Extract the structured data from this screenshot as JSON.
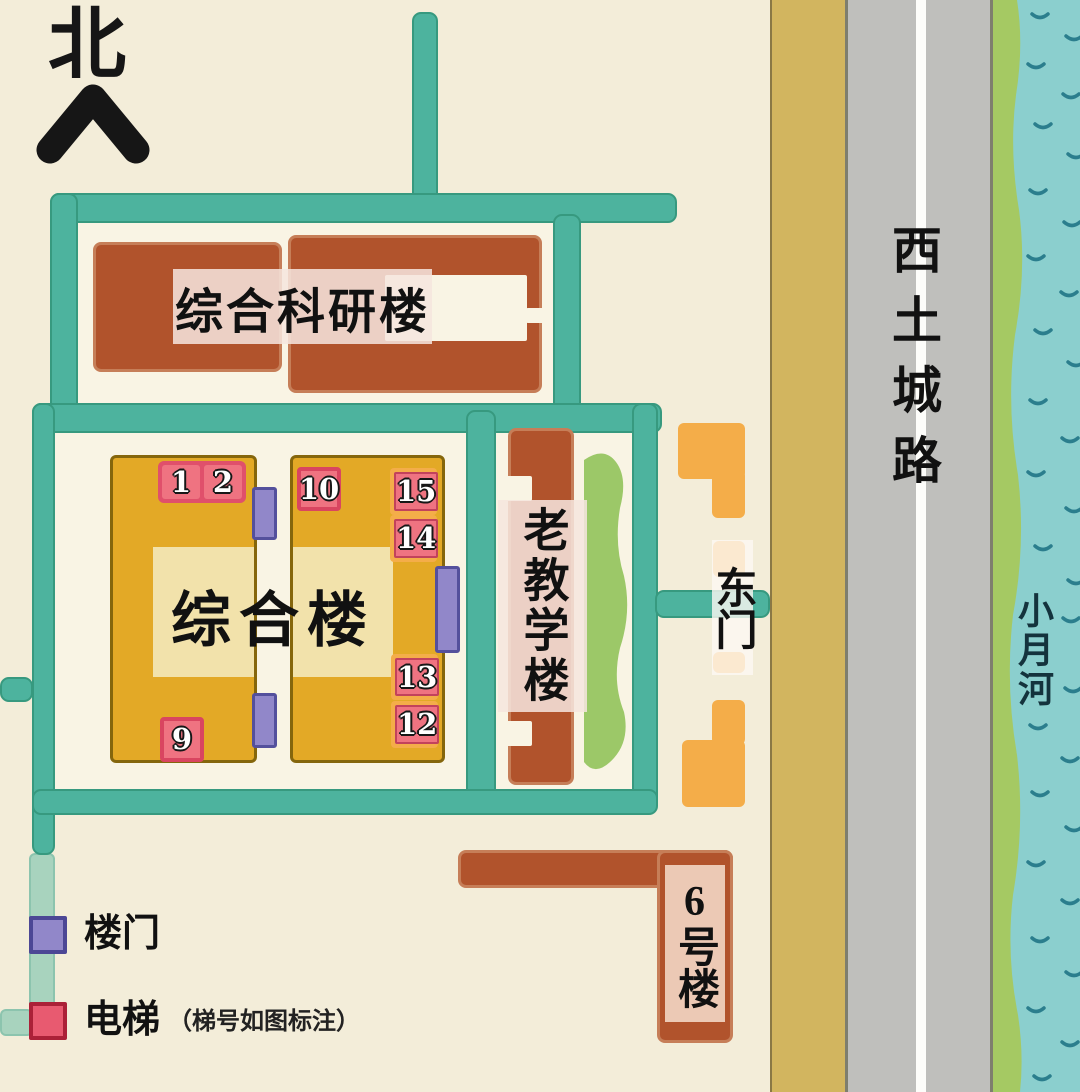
{
  "north_label": "北",
  "labels": {
    "research": "综合科研楼",
    "main_building": "综合楼",
    "old_teaching": "老教学楼",
    "east_gate": "东门",
    "building_6": "6号楼",
    "road": "西土城路",
    "river": "小月河"
  },
  "elevators": [
    {
      "label": "1"
    },
    {
      "label": "2"
    },
    {
      "label": "10"
    },
    {
      "label": "15"
    },
    {
      "label": "14"
    },
    {
      "label": "13"
    },
    {
      "label": "12"
    },
    {
      "label": "9"
    }
  ],
  "legend": {
    "door_label": "楼门",
    "elevator_label": "电梯",
    "elevator_note": "（梯号如图标注）"
  },
  "colors": {
    "cream": "#f3edd9",
    "courtyard": "#f9f4e4",
    "teal": "#4db39e",
    "teal-dark": "#37997f",
    "brown": "#b1532c",
    "brown-border": "#c67e58",
    "yellow": "#e3a926",
    "yellow-border": "#85660c",
    "yellow-light": "#f2e2ab",
    "orange": "#f4ad49",
    "purple": "#9187c9",
    "purple-border": "#54509c",
    "pink": "#ef7381",
    "pink-border": "#e0506b",
    "red-border": "#d94560",
    "tan": "#d2b55f",
    "road": "#bfbfbc",
    "road-border": "#7e7e6e",
    "bank": "#a5c963",
    "river": "#8bcfce",
    "wave": "#2b7e8d"
  }
}
